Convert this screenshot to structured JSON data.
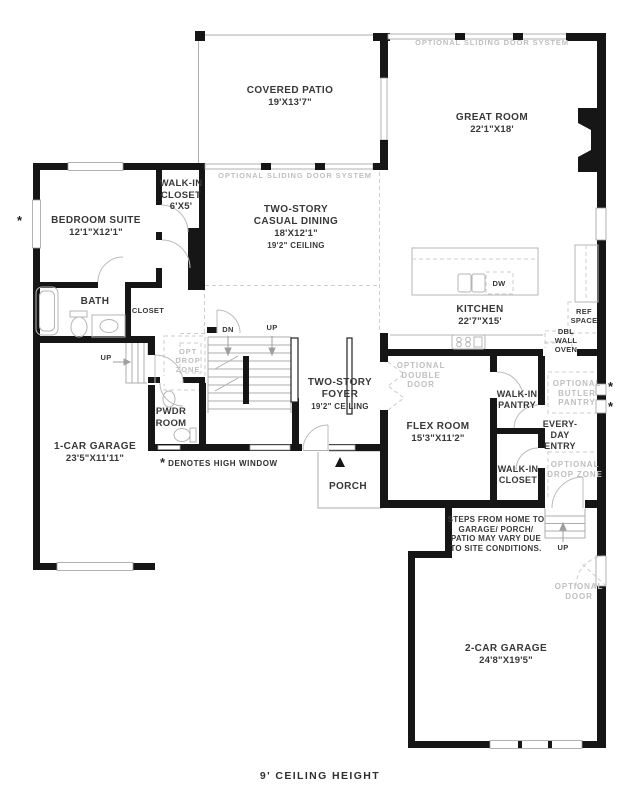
{
  "rooms": {
    "covered_patio": {
      "name": "COVERED PATIO",
      "dims": "19'X13'7\""
    },
    "great_room": {
      "name": "GREAT ROOM",
      "dims": "22'1\"X18'"
    },
    "casual_dining": {
      "line1": "TWO-STORY",
      "line2": "CASUAL DINING",
      "dims": "18'X12'1\"",
      "ceiling": "19'2\" CEILING"
    },
    "bedroom_suite": {
      "name": "BEDROOM SUITE",
      "dims": "12'1\"X12'1\""
    },
    "walk_in_closet_1": {
      "line1": "WALK-IN",
      "line2": "CLOSET",
      "dims": "6'X5'"
    },
    "bath": {
      "name": "BATH"
    },
    "closet": {
      "name": "CLOSET"
    },
    "kitchen": {
      "name": "KITCHEN",
      "dims": "22'7\"X15'"
    },
    "foyer": {
      "line1": "TWO-STORY",
      "line2": "FOYER",
      "ceiling": "19'2\" CEILING"
    },
    "pwdr_room": {
      "line1": "PWDR",
      "line2": "ROOM"
    },
    "one_car_garage": {
      "name": "1-CAR GARAGE",
      "dims": "23'5\"X11'11\""
    },
    "flex_room": {
      "name": "FLEX ROOM",
      "dims": "15'3\"X11'2\""
    },
    "walk_in_pantry": {
      "line1": "WALK-IN",
      "line2": "PANTRY"
    },
    "every_day_entry": {
      "line1": "EVERY-",
      "line2": "DAY",
      "line3": "ENTRY"
    },
    "walk_in_closet_2": {
      "line1": "WALK-IN",
      "line2": "CLOSET"
    },
    "porch": {
      "name": "PORCH"
    },
    "two_car_garage": {
      "name": "2-CAR GARAGE",
      "dims": "24'8\"X19'5\""
    }
  },
  "features": {
    "dw": "DW",
    "ref_space": [
      "REF",
      "SPACE"
    ],
    "dbl_wall_oven": [
      "DBL",
      "WALL",
      "OVEN"
    ],
    "dn": "DN",
    "up": "UP"
  },
  "annotations": {
    "sliding_door_system": "OPTIONAL SLIDING DOOR SYSTEM",
    "optional_double_door": [
      "OPTIONAL",
      "DOUBLE",
      "DOOR"
    ],
    "optional_butler_pantry": [
      "OPTIONAL",
      "BUTLER",
      "PANTRY"
    ],
    "optional_drop_zone": [
      "OPTIONAL",
      "DROP ZONE"
    ],
    "opt_drop_zone": [
      "OPT",
      "DROP",
      "ZONE"
    ],
    "optional_door": [
      "OPTIONAL",
      "DOOR"
    ],
    "steps_note": [
      "STEPS FROM HOME TO",
      "GARAGE/ PORCH/",
      "PATIO MAY VARY DUE",
      "TO SITE CONDITIONS."
    ],
    "legend": {
      "symbol": "*",
      "text": "DENOTES HIGH WINDOW"
    },
    "high_window_symbol": "*",
    "footer": "9' CEILING HEIGHT"
  },
  "colors": {
    "wall": "#161616",
    "text_primary": "#383838",
    "text_muted": "#bfbfbf",
    "thin_line": "#aeaeae",
    "dashed_line": "#cdcdcd"
  }
}
